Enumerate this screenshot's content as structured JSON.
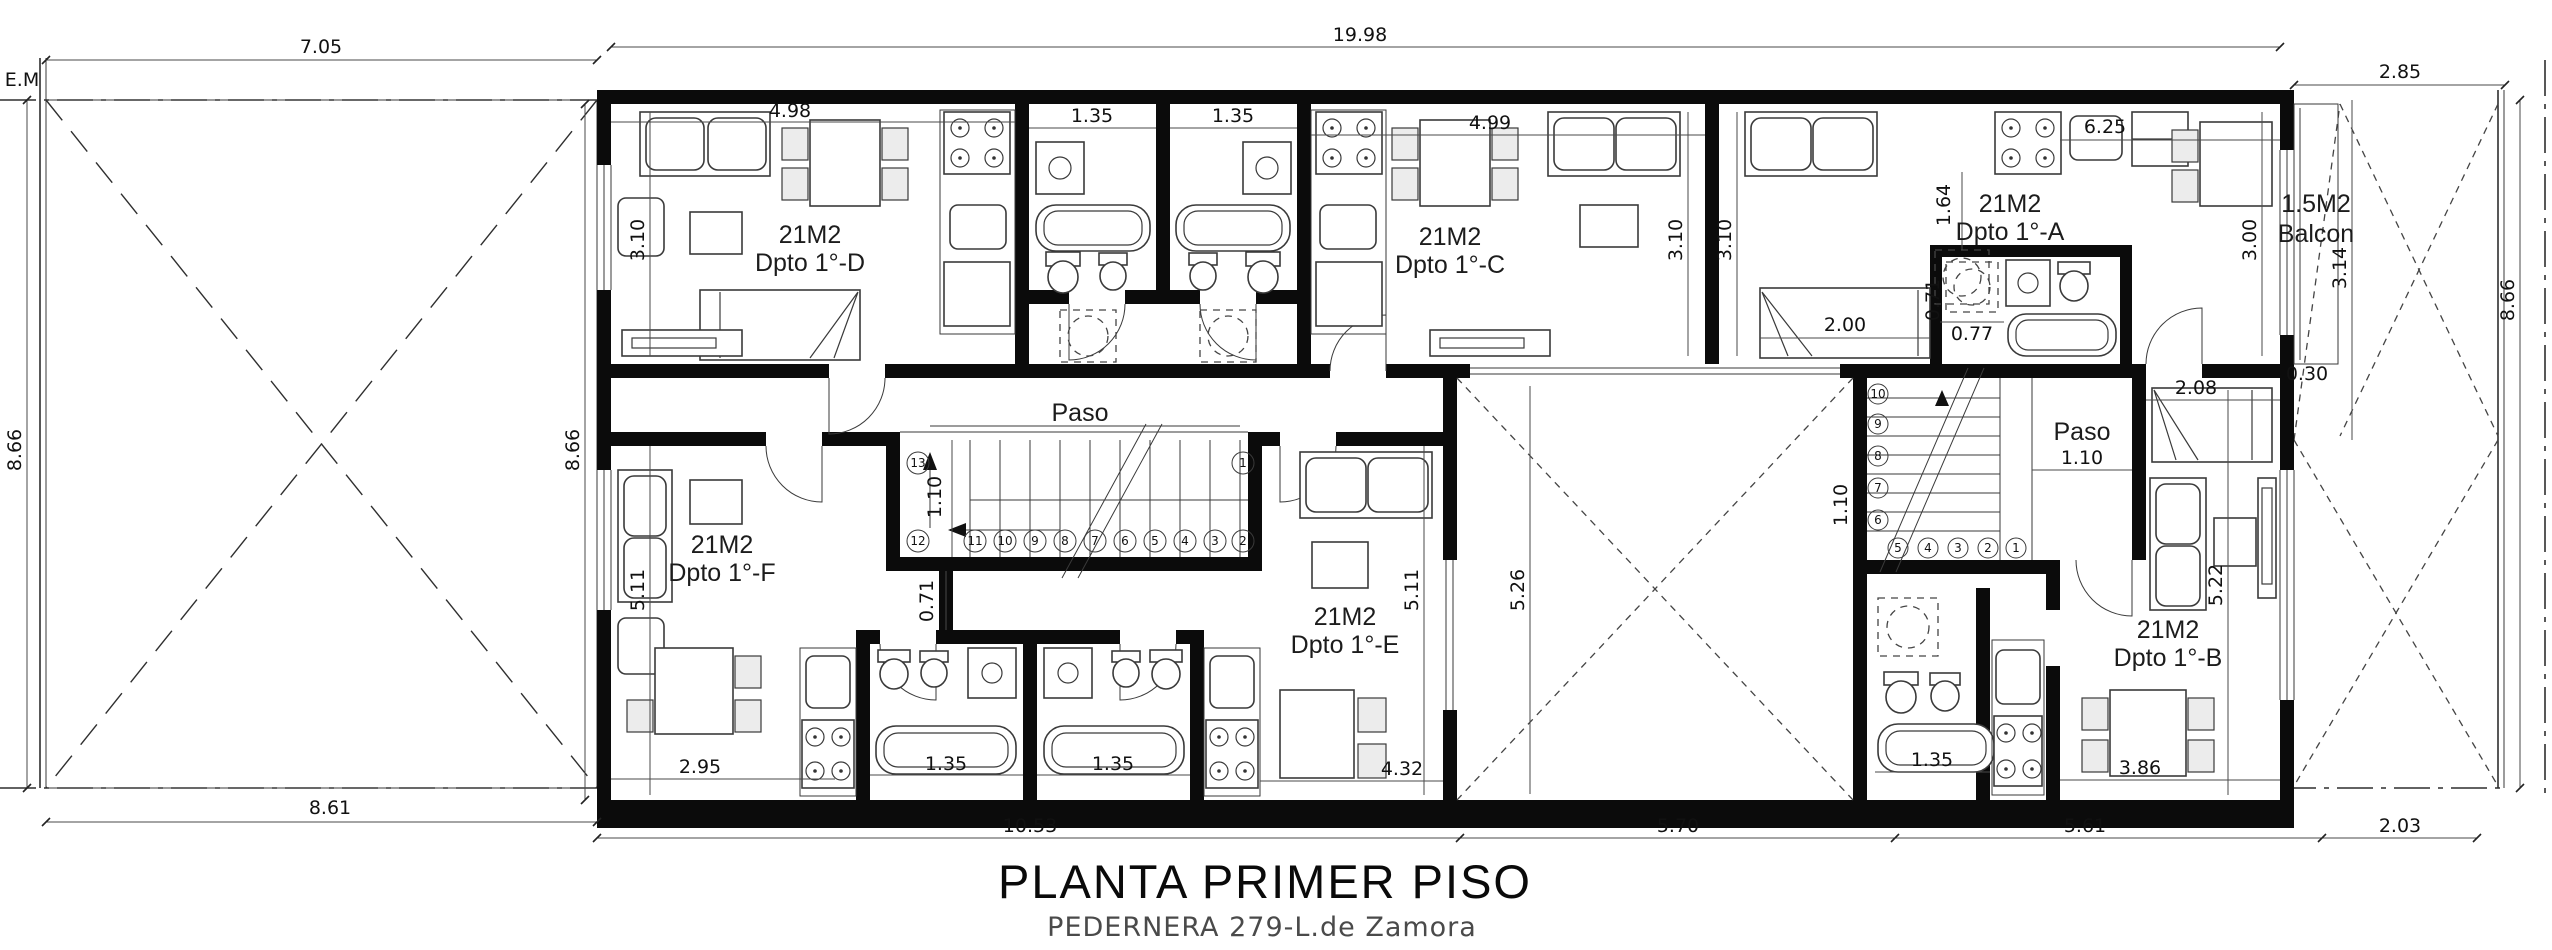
{
  "title": {
    "main": "PLANTA PRIMER PISO",
    "subtitle": "PEDERNERA 279-L.de Zamora"
  },
  "site": {
    "em_label": "E.M"
  },
  "corridors": {
    "paso_left": "Paso",
    "paso_right": "Paso"
  },
  "units": {
    "d": {
      "area": "21M2",
      "name": "Dpto 1°-D"
    },
    "c": {
      "area": "21M2",
      "name": "Dpto 1°-C"
    },
    "a": {
      "area": "21M2",
      "name": "Dpto 1°-A"
    },
    "f": {
      "area": "21M2",
      "name": "Dpto 1°-F"
    },
    "e": {
      "area": "21M2",
      "name": "Dpto 1°-E"
    },
    "b": {
      "area": "21M2",
      "name": "Dpto 1°-B"
    },
    "balcony": {
      "area": "1.5M2",
      "name": "Balcon"
    }
  },
  "dims": {
    "top_patio": "7.05",
    "top_building": "19.98",
    "top_right": "2.85",
    "lot_left": "8.66",
    "building_left": "8.66",
    "lot_right": "8.66",
    "bottom_patio": "8.61",
    "bottom_building": "10.53",
    "bottom_courtyard": "5.70",
    "bottom_unit_b": "5.61",
    "bottom_right": "2.03",
    "unit_d_width": "4.98",
    "unit_d_height": "3.10",
    "bath_d1": "1.35",
    "bath_d2": "1.35",
    "unit_c_width": "4.99",
    "unit_c_height": "3.10",
    "unit_a_left_height": "3.10",
    "unit_a_kitchen": "6.25",
    "unit_a_laundry": "1.64",
    "unit_a_bed": "2.00",
    "unit_a_bath_width": "0.77",
    "unit_a_bath_height": "0.71",
    "unit_a_living_height": "3.00",
    "balcony_height": "3.14",
    "balcony_depth": "0.30",
    "stair_main_width": "1.10",
    "stair_main_wall": "0.71",
    "unit_f_height": "5.11",
    "unit_f_width": "2.95",
    "bath_f": "1.35",
    "bath_e": "1.35",
    "unit_e_width": "4.32",
    "unit_e_height": "5.11",
    "courtyard_height": "5.26",
    "stair_right_width": "1.10",
    "paso_right_width": "1.10",
    "unit_b_bed": "2.08",
    "unit_b_height": "5.22",
    "unit_b_bath": "1.35",
    "unit_b_table": "3.86"
  },
  "stairs": {
    "numbers": [
      "1",
      "2",
      "3",
      "4",
      "5",
      "6",
      "7",
      "8",
      "9",
      "10",
      "11",
      "12",
      "13"
    ]
  },
  "colors": {
    "walls": "#0b0b0b",
    "lines": "#2e2e2e",
    "dim_text": "#111111",
    "subtitle_text": "#4a4a4a"
  }
}
